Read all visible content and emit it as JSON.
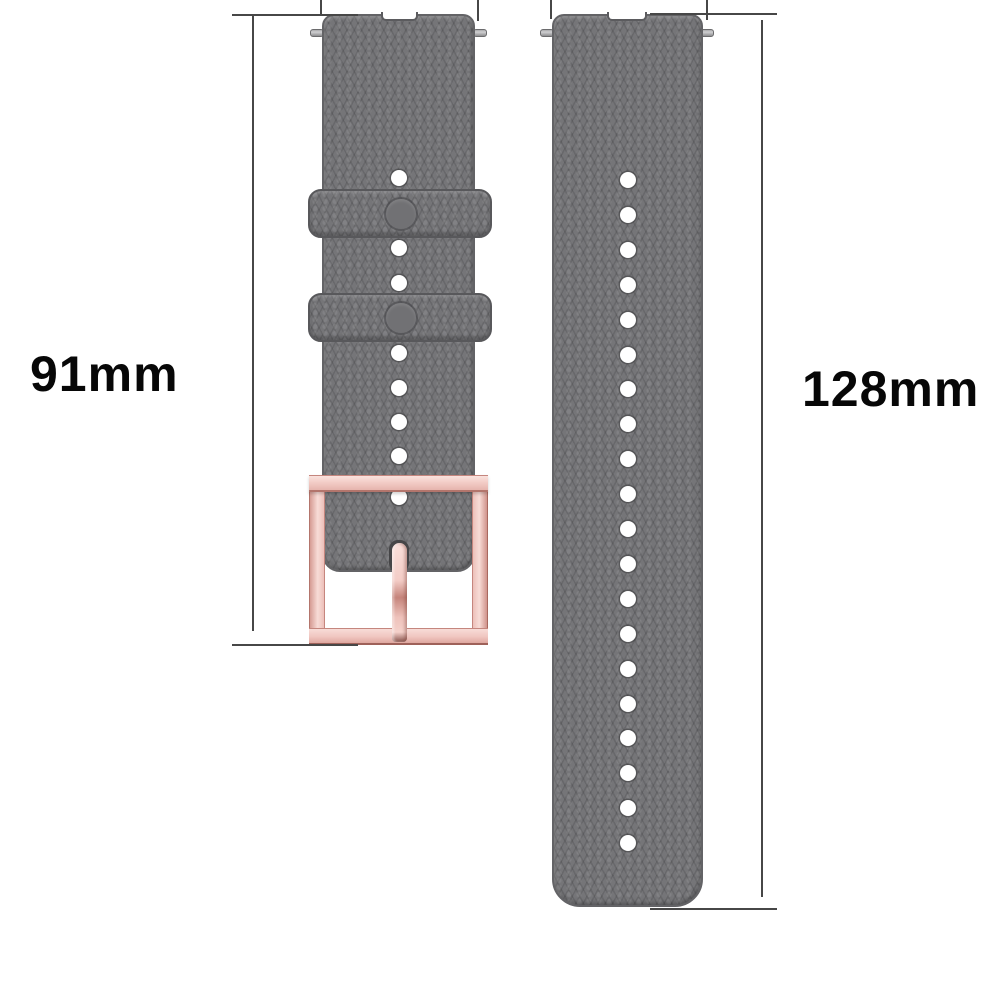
{
  "background": "#ffffff",
  "annotations": {
    "left": {
      "label": "91mm"
    },
    "right": {
      "label": "128mm"
    },
    "line_color": "#474747",
    "label_color": "#070707"
  },
  "product": {
    "band_color": "#757578",
    "band_texture": "diamond-grid silicone",
    "buckle_color": "#f3cdc7",
    "hole_color": "#ffffff",
    "left_strap": {
      "visible_holes": 8,
      "keeper_loops": 2,
      "keeper_buttons": 2,
      "has_buckle": true
    },
    "right_strap": {
      "visible_holes": 20
    },
    "spring_bar_pins": 4
  }
}
